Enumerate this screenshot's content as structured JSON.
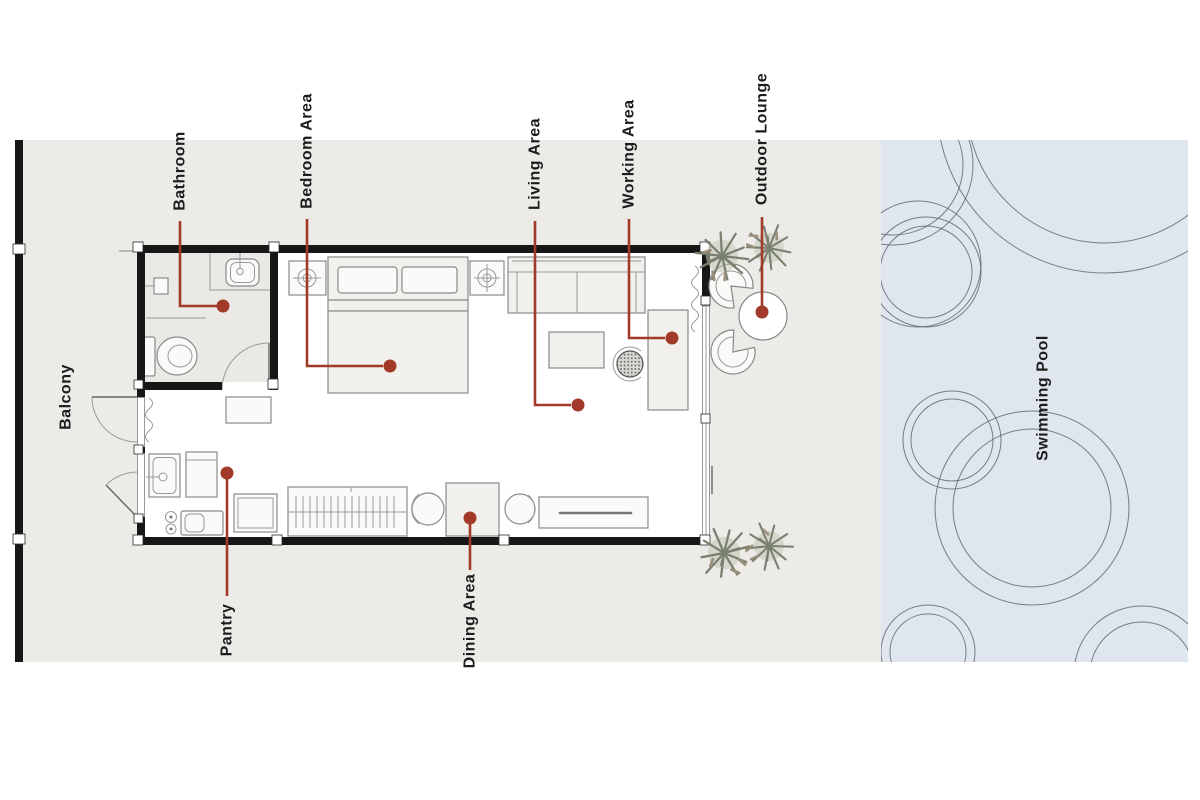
{
  "labels": {
    "bathroom": "Bathroom",
    "bedroom_area": "Bedroom Area",
    "living_area": "Living Area",
    "working_area": "Working Area",
    "outdoor_lounge": "Outdoor Lounge",
    "balcony": "Balcony",
    "pantry": "Pantry",
    "dining_area": "Dining Area",
    "swimming_pool": "Swimming Pool"
  },
  "colors": {
    "leader_line": "#a23a29",
    "wall": "#171717",
    "site_ground": "#edebe8",
    "pool_water": "#dfe6ee",
    "pool_ripple": "#5a6272",
    "bathroom_floor": "#ebe9e6",
    "furniture_outline": "#8a8a8a",
    "plant_foliage": "#7a8070",
    "label_text": "#1c1c1c"
  }
}
